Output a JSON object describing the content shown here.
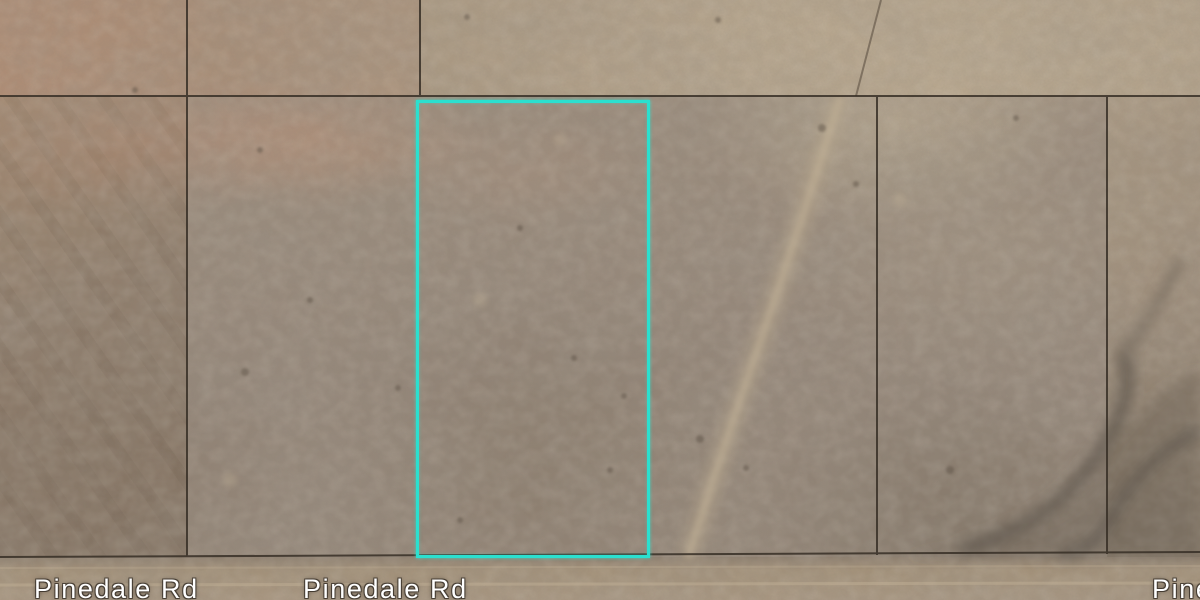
{
  "map": {
    "view_type": "satellite",
    "road_labels": [
      {
        "text": "Pinedale Rd"
      },
      {
        "text": "Pinedale Rd"
      },
      {
        "text": "Pinedale Rd"
      }
    ],
    "selected_parcel": {
      "outline_color": "#2be0cf"
    },
    "colors": {
      "parcel_line": "#372f26",
      "terrain_base": "#9c8b78",
      "road_label_text": "#ffffff"
    }
  }
}
